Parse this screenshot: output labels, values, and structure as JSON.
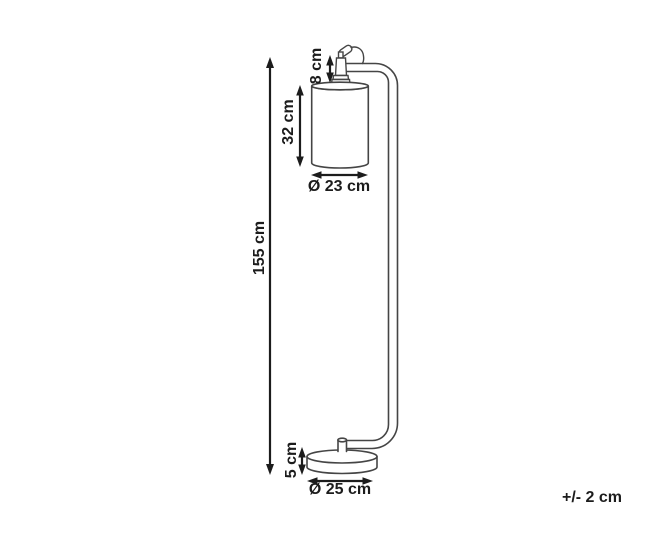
{
  "diagram": {
    "title": "floor-lamp-dimension-diagram",
    "labels": {
      "total_height": "155 cm",
      "socket_height": "8 cm",
      "shade_height": "32 cm",
      "shade_diameter": "Ø 23 cm",
      "base_height": "5 cm",
      "base_diameter": "Ø 25 cm",
      "tolerance": "+/- 2 cm"
    },
    "colors": {
      "line_art": "#454545",
      "dimension": "#1c1c1c",
      "background": "#ffffff"
    }
  }
}
